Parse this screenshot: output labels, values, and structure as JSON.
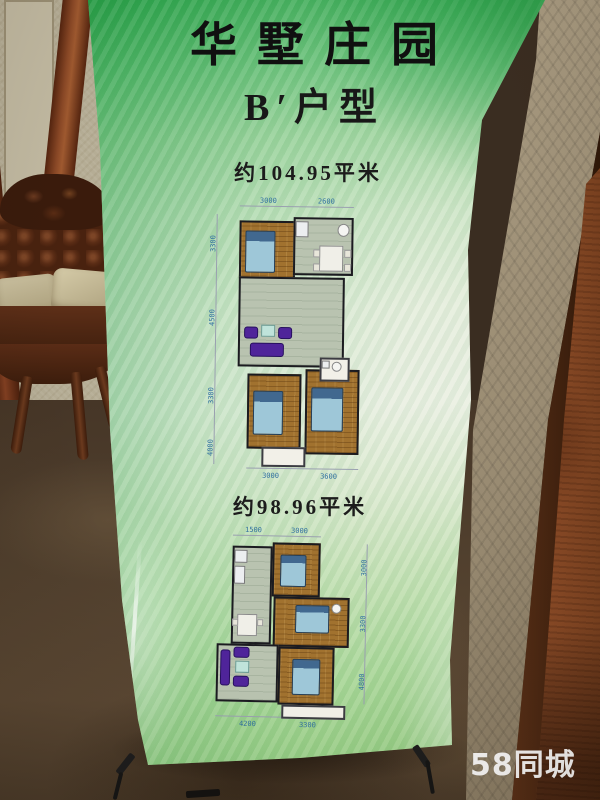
{
  "scene": {
    "watermark": "58同城"
  },
  "colors": {
    "banner_green_top": "#35a751",
    "banner_pale_middle": "#eaf0e2",
    "banner_green_bottom": "#93cd80",
    "wood_floor": "#a1722f",
    "tile_floor": "#b9c3b0",
    "sofa_purple": "#4f249a",
    "bed_blue": "#9ec7d8",
    "dim_label_blue": "#2f6fa0",
    "watermark_white": "#ffffff",
    "leather_brown": "#5a2c15",
    "door_wood": "#8a4a26"
  },
  "banner": {
    "title": "华墅庄园",
    "subtitle": "B′户型",
    "plans": [
      {
        "area_label": "约104.95平米",
        "dims": {
          "top": [
            {
              "t": "3000",
              "x": 54,
              "y": 2
            },
            {
              "t": "2600",
              "x": 112,
              "y": 2
            }
          ],
          "left": [
            {
              "t": "3300",
              "x": 4,
              "y": 58
            },
            {
              "t": "4500",
              "x": 4,
              "y": 132
            },
            {
              "t": "3300",
              "x": 4,
              "y": 210
            },
            {
              "t": "4000",
              "x": 4,
              "y": 262
            }
          ],
          "bottom": [
            {
              "t": "3000",
              "x": 60,
              "y": 277
            },
            {
              "t": "3600",
              "x": 118,
              "y": 277
            }
          ]
        },
        "lines": [
          [
            34,
            11,
            114,
            1
          ],
          [
            11,
            20,
            1,
            250
          ],
          [
            44,
            273,
            112,
            1
          ]
        ],
        "rooms": [
          {
            "name": "bedroom-top-left",
            "type": "wood",
            "r": [
              34,
              26,
              56,
              58
            ]
          },
          {
            "name": "kitchen-dining",
            "type": "tile",
            "r": [
              88,
              22,
              60,
              58
            ]
          },
          {
            "name": "living-room",
            "type": "tile",
            "r": [
              34,
              82,
              106,
              90
            ]
          },
          {
            "name": "bedroom-bottom-left",
            "type": "wood",
            "r": [
              44,
              179,
              54,
              75
            ]
          },
          {
            "name": "bedroom-bottom-right",
            "type": "wood",
            "r": [
              102,
              174,
              54,
              85
            ]
          },
          {
            "name": "balcony",
            "type": "open",
            "r": [
              59,
              252,
              44,
              20
            ]
          },
          {
            "name": "bathroom",
            "type": "open",
            "r": [
              116,
              162,
              30,
              24
            ]
          }
        ],
        "furniture": [
          {
            "kind": "bed",
            "name": "bed",
            "r": [
              40,
              36,
              30,
              42
            ]
          },
          {
            "kind": "fridge",
            "name": "fridge",
            "r": [
              90,
              26,
              13,
              16
            ]
          },
          {
            "kind": "round",
            "name": "sink",
            "r": [
              132,
              28,
              12,
              13
            ]
          },
          {
            "kind": "table",
            "name": "dining-table",
            "r": [
              114,
              50,
              24,
              26
            ]
          },
          {
            "kind": "chairw",
            "name": "dining-chair",
            "r": [
              108,
              54,
              7,
              8
            ]
          },
          {
            "kind": "chairw",
            "name": "dining-chair",
            "r": [
              139,
              54,
              7,
              8
            ]
          },
          {
            "kind": "chairw",
            "name": "dining-chair",
            "r": [
              108,
              68,
              7,
              8
            ]
          },
          {
            "kind": "chairw",
            "name": "dining-chair",
            "r": [
              139,
              68,
              7,
              8
            ]
          },
          {
            "kind": "sofa",
            "name": "armchair",
            "r": [
              40,
              132,
              14,
              12
            ]
          },
          {
            "kind": "coffee",
            "name": "coffee-table",
            "r": [
              57,
              130,
              14,
              12
            ]
          },
          {
            "kind": "sofa",
            "name": "armchair",
            "r": [
              74,
              132,
              14,
              12
            ]
          },
          {
            "kind": "sofa",
            "name": "sofa",
            "r": [
              46,
              148,
              34,
              14
            ]
          },
          {
            "kind": "fridge",
            "name": "basin",
            "r": [
              118,
              165,
              8,
              8
            ]
          },
          {
            "kind": "round",
            "name": "toilet",
            "r": [
              128,
              166,
              10,
              10
            ]
          },
          {
            "kind": "bed",
            "name": "bed",
            "r": [
              50,
              196,
              30,
              44
            ]
          },
          {
            "kind": "bed",
            "name": "bed",
            "r": [
              108,
              192,
              32,
              44
            ]
          }
        ]
      },
      {
        "area_label": "约98.96平米",
        "dims": {
          "top": [
            {
              "t": "1500",
              "x": 36,
              "y": 0
            },
            {
              "t": "3000",
              "x": 82,
              "y": 0
            }
          ],
          "right": [
            {
              "t": "3000",
              "x": 152,
              "y": 48
            },
            {
              "t": "3300",
              "x": 152,
              "y": 104
            },
            {
              "t": "4800",
              "x": 152,
              "y": 162
            }
          ],
          "bottom": [
            {
              "t": "4200",
              "x": 34,
              "y": 194
            },
            {
              "t": "3300",
              "x": 94,
              "y": 194
            }
          ]
        },
        "lines": [
          [
            24,
            9,
            88,
            1
          ],
          [
            158,
            16,
            1,
            160
          ],
          [
            10,
            190,
            118,
            1
          ]
        ],
        "rooms": [
          {
            "name": "kitchen-dining",
            "type": "tile",
            "r": [
              24,
              20,
              40,
              98
            ]
          },
          {
            "name": "bedroom-top",
            "type": "wood",
            "r": [
              64,
              16,
              48,
              54
            ]
          },
          {
            "name": "bedroom-middle",
            "type": "wood",
            "r": [
              66,
              70,
              76,
              50
            ]
          },
          {
            "name": "living-room",
            "type": "tile",
            "r": [
              10,
              118,
              62,
              58
            ]
          },
          {
            "name": "bedroom-bottom",
            "type": "wood",
            "r": [
              72,
              120,
              56,
              58
            ]
          },
          {
            "name": "balcony",
            "type": "open",
            "r": [
              76,
              178,
              64,
              14
            ]
          }
        ],
        "furniture": [
          {
            "kind": "fridge",
            "name": "fridge",
            "r": [
              26,
              24,
              13,
              13
            ]
          },
          {
            "kind": "fridge",
            "name": "counter",
            "r": [
              26,
              40,
              11,
              18
            ]
          },
          {
            "kind": "table",
            "name": "dining-table",
            "r": [
              30,
              88,
              20,
              22
            ]
          },
          {
            "kind": "chairw",
            "name": "dining-chair",
            "r": [
              25,
              93,
              6,
              7
            ]
          },
          {
            "kind": "chairw",
            "name": "dining-chair",
            "r": [
              50,
              93,
              6,
              7
            ]
          },
          {
            "kind": "bed",
            "name": "bed",
            "r": [
              72,
              28,
              26,
              32
            ]
          },
          {
            "kind": "round",
            "name": "toilet",
            "r": [
              124,
              76,
              10,
              10
            ]
          },
          {
            "kind": "bed",
            "name": "bed",
            "r": [
              88,
              78,
              34,
              28
            ]
          },
          {
            "kind": "sofa",
            "name": "sofa",
            "r": [
              14,
              124,
              10,
              36
            ]
          },
          {
            "kind": "sofa",
            "name": "armchair",
            "r": [
              27,
              121,
              16,
              11
            ]
          },
          {
            "kind": "coffee",
            "name": "coffee-table",
            "r": [
              29,
              135,
              14,
              12
            ]
          },
          {
            "kind": "sofa",
            "name": "armchair",
            "r": [
              27,
              150,
              16,
              11
            ]
          },
          {
            "kind": "bed",
            "name": "bed",
            "r": [
              86,
              132,
              28,
              36
            ]
          }
        ]
      }
    ]
  }
}
